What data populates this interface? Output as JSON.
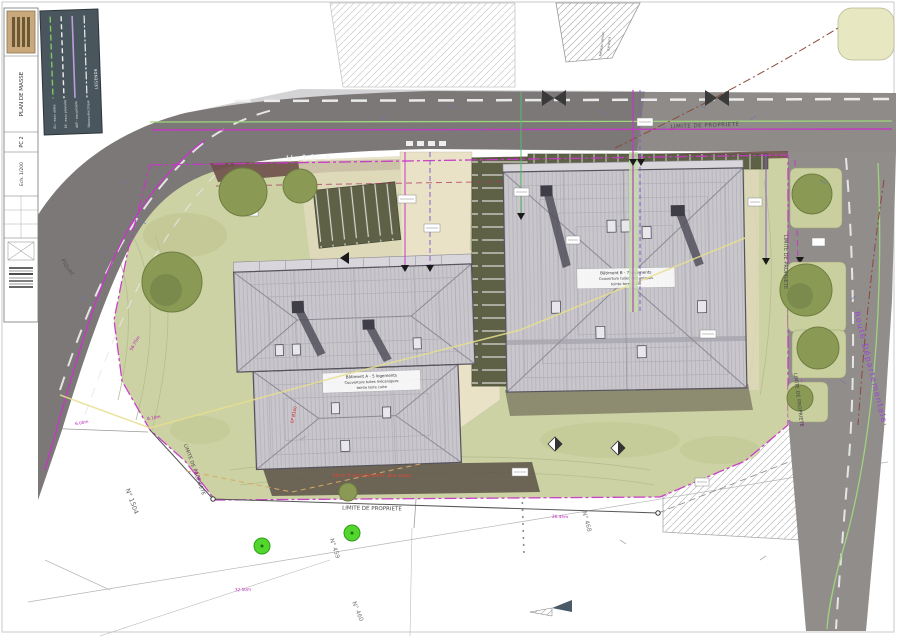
{
  "drawing": {
    "sheet_title": "PLAN DE MASSE",
    "sheet_code": "PC 2",
    "scale": "Ech. 1/200"
  },
  "legend": {
    "title": "LEGENDE",
    "items": [
      {
        "label": "EU - eaux usées",
        "color": "#7ec860",
        "style": "dashed"
      },
      {
        "label": "EP - eaux pluviales",
        "color": "#eeeeee",
        "style": "dashed"
      },
      {
        "label": "AEP - eau potable",
        "color": "#c09ae0",
        "style": "solid"
      },
      {
        "label": "Réseau électrique",
        "color": "#eeeeee",
        "style": "dashdot"
      }
    ]
  },
  "labels": {
    "limite_propriete": "LIMITE DE PROPRIETE",
    "route_departementale": "Route Départementale",
    "piquet": "Piquet",
    "v11a": "V 11 a",
    "red_note": "Sens d'écoulement des eaux",
    "ep_note": "EP Ø100",
    "aerial_note_1": "Réseau aérien",
    "aerial_note_2": "existant"
  },
  "parcels": {
    "p1504": "N° 1504",
    "p1505": "N° 1505",
    "p459": "N° 459",
    "p460": "N° 460",
    "p468": "N° 468"
  },
  "measurements": {
    "m1": "6.00m",
    "m2": "8.10m",
    "m3": "14.30m",
    "m4": "32.50m",
    "m5": "26.45m",
    "m6": "56.75m"
  },
  "buildings": {
    "a": {
      "line1": "Bâtiment A - 5 logements",
      "line2": "Couverture tuiles mécaniques",
      "line3": "teinte terre cuite"
    },
    "b": {
      "line1": "Bâtiment B - 7 logements",
      "line2": "Couverture tuiles mécaniques",
      "line3": "teinte terre cuite"
    }
  },
  "colors": {
    "lawn": "#ccd2a3",
    "road": "#8f8b88",
    "roof": "#c9c7cc",
    "boundary_magenta": "#c837c8",
    "purple_label": "#9b46d8",
    "legend_bg": "#49565e",
    "tree_olive": "#8a9a55",
    "tree_bright": "#52d62e",
    "maroon_band": "#6d4f49"
  }
}
